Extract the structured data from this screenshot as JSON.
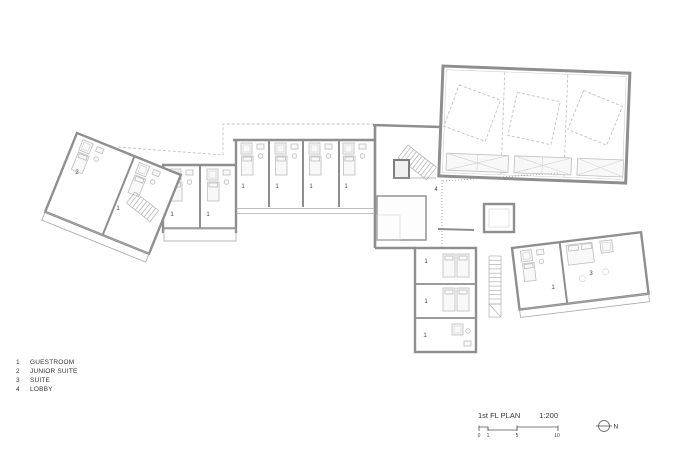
{
  "drawing": {
    "type": "architectural floor plan",
    "wall_color": "#8e8e8e",
    "furniture_color": "#bdbdbd",
    "dashed_roof_color": "#c2c2c2",
    "label_color": "#444444",
    "background": "#ffffff"
  },
  "plan": {
    "rooms": {
      "left_wing_junior_suite": "2",
      "left_wing_guestroom": "1",
      "wing2_guestroom_a": "1",
      "wing2_guestroom_b": "1",
      "row_guestroom_1": "1",
      "row_guestroom_2": "1",
      "row_guestroom_3": "1",
      "row_guestroom_4": "1",
      "lobby": "4",
      "south_guestroom_1": "1",
      "south_guestroom_2": "1",
      "south_guestroom_3": "1",
      "east_wing_guestroom": "1",
      "east_wing_suite": "3"
    }
  },
  "legend": {
    "items": [
      {
        "number": "1",
        "label": "GUESTROOM"
      },
      {
        "number": "2",
        "label": "JUNIOR SUITE"
      },
      {
        "number": "3",
        "label": "SUITE"
      },
      {
        "number": "4",
        "label": "LOBBY"
      }
    ]
  },
  "title_block": {
    "title": "1st FL PLAN",
    "scale": "1:200",
    "scale_ticks": [
      "0",
      "1",
      "5",
      "10"
    ],
    "north_label": "N"
  }
}
